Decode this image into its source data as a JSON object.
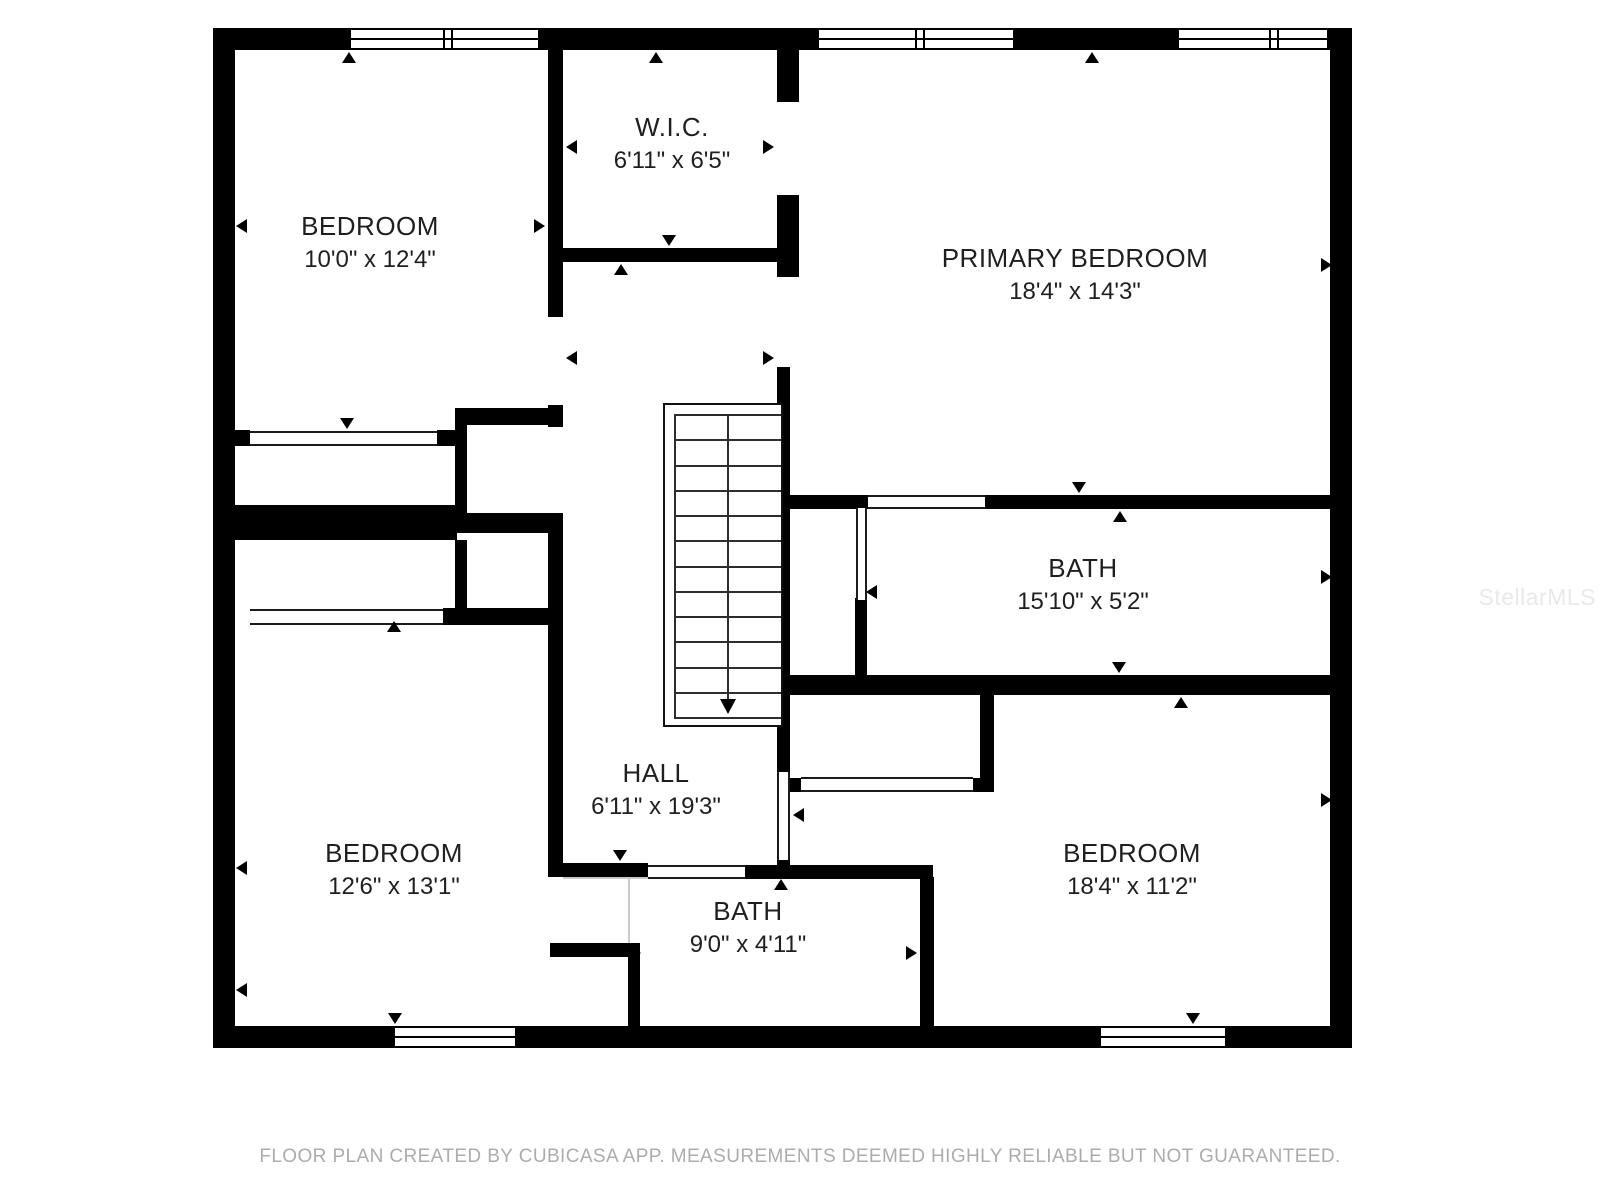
{
  "floorplan": {
    "background_color": "#ffffff",
    "wall_color": "#000000",
    "label_color": "#1f1f1f",
    "rooms": [
      {
        "name": "BEDROOM",
        "dims": "10'0\" x 12'4\"",
        "cx": 370,
        "cy": 243
      },
      {
        "name": "W.I.C.",
        "dims": "6'11\" x 6'5\"",
        "cx": 672,
        "cy": 144
      },
      {
        "name": "PRIMARY BEDROOM",
        "dims": "18'4\" x 14'3\"",
        "cx": 1075,
        "cy": 275
      },
      {
        "name": "BATH",
        "dims": "15'10\" x 5'2\"",
        "cx": 1083,
        "cy": 585
      },
      {
        "name": "HALL",
        "dims": "6'11\" x 19'3\"",
        "cx": 656,
        "cy": 790
      },
      {
        "name": "BEDROOM",
        "dims": "12'6\" x 13'1\"",
        "cx": 394,
        "cy": 870
      },
      {
        "name": "BATH",
        "dims": "9'0\" x 4'11\"",
        "cx": 748,
        "cy": 928
      },
      {
        "name": "BEDROOM",
        "dims": "18'4\" x 11'2\"",
        "cx": 1132,
        "cy": 870
      }
    ],
    "walls": [
      [
        213,
        28,
        22,
        1020
      ],
      [
        1330,
        28,
        22,
        1020
      ],
      [
        213,
        28,
        133,
        22
      ],
      [
        543,
        28,
        271,
        22
      ],
      [
        1018,
        28,
        156,
        22
      ],
      [
        213,
        1026,
        177,
        22
      ],
      [
        520,
        1026,
        576,
        22
      ],
      [
        1230,
        1026,
        122,
        22
      ],
      [
        548,
        50,
        15,
        267
      ],
      [
        777,
        50,
        22,
        52
      ],
      [
        777,
        195,
        22,
        82
      ],
      [
        562,
        248,
        237,
        14
      ],
      [
        777,
        367,
        13,
        405
      ],
      [
        213,
        505,
        244,
        35
      ],
      [
        455,
        408,
        12,
        120
      ],
      [
        455,
        408,
        105,
        17
      ],
      [
        548,
        405,
        15,
        22
      ],
      [
        548,
        513,
        15,
        112
      ],
      [
        455,
        513,
        105,
        20
      ],
      [
        455,
        540,
        12,
        85
      ],
      [
        443,
        608,
        120,
        17
      ],
      [
        235,
        430,
        15,
        16
      ],
      [
        437,
        430,
        20,
        16
      ],
      [
        548,
        625,
        15,
        252
      ],
      [
        548,
        863,
        100,
        14
      ],
      [
        550,
        943,
        90,
        14
      ],
      [
        628,
        943,
        12,
        83
      ],
      [
        745,
        865,
        188,
        14
      ],
      [
        920,
        877,
        14,
        149
      ],
      [
        788,
        495,
        80,
        14
      ],
      [
        985,
        495,
        367,
        14
      ],
      [
        855,
        598,
        12,
        77
      ],
      [
        788,
        675,
        564,
        20
      ],
      [
        980,
        690,
        14,
        100
      ],
      [
        790,
        778,
        12,
        14
      ],
      [
        973,
        778,
        21,
        14
      ],
      [
        777,
        858,
        13,
        10
      ]
    ],
    "windows": [
      {
        "x": 346,
        "y": 28,
        "w": 197,
        "h": 22,
        "m": [
          92,
          100
        ]
      },
      {
        "x": 814,
        "y": 28,
        "w": 204,
        "h": 22,
        "m": [
          96,
          104
        ]
      },
      {
        "x": 1174,
        "y": 28,
        "w": 158,
        "h": 22,
        "m": [
          90,
          98
        ]
      },
      {
        "x": 390,
        "y": 1026,
        "w": 130,
        "h": 22,
        "m": []
      },
      {
        "x": 1096,
        "y": 1026,
        "w": 134,
        "h": 22,
        "m": []
      }
    ],
    "openings": [
      {
        "x": 250,
        "y": 431,
        "w": 187,
        "h": 15,
        "o": "h"
      },
      {
        "x": 250,
        "y": 609,
        "w": 193,
        "h": 16,
        "o": "h"
      },
      {
        "x": 648,
        "y": 865,
        "w": 97,
        "h": 14,
        "o": "h"
      },
      {
        "x": 801,
        "y": 777,
        "w": 172,
        "h": 15,
        "o": "h"
      },
      {
        "x": 868,
        "y": 495,
        "w": 117,
        "h": 14,
        "o": "h"
      },
      {
        "x": 777,
        "y": 772,
        "w": 13,
        "h": 88,
        "o": "v"
      },
      {
        "x": 856,
        "y": 508,
        "w": 11,
        "h": 92,
        "o": "v"
      }
    ],
    "boundary_lines": [
      [
        563,
        877,
        85,
        2
      ],
      [
        628,
        877,
        2,
        66
      ]
    ],
    "markers": [
      {
        "x": 349,
        "y": 52,
        "dir": "up"
      },
      {
        "x": 656,
        "y": 52,
        "dir": "up"
      },
      {
        "x": 1092,
        "y": 52,
        "dir": "up"
      },
      {
        "x": 236,
        "y": 226,
        "dir": "left"
      },
      {
        "x": 236,
        "y": 868,
        "dir": "left"
      },
      {
        "x": 236,
        "y": 990,
        "dir": "left"
      },
      {
        "x": 545,
        "y": 226,
        "dir": "right"
      },
      {
        "x": 566,
        "y": 147,
        "dir": "left"
      },
      {
        "x": 774,
        "y": 147,
        "dir": "right"
      },
      {
        "x": 669,
        "y": 246,
        "dir": "down"
      },
      {
        "x": 621,
        "y": 264,
        "dir": "up"
      },
      {
        "x": 566,
        "y": 358,
        "dir": "left"
      },
      {
        "x": 774,
        "y": 358,
        "dir": "right"
      },
      {
        "x": 1079,
        "y": 493,
        "dir": "down"
      },
      {
        "x": 1120,
        "y": 511,
        "dir": "up"
      },
      {
        "x": 1332,
        "y": 265,
        "dir": "right"
      },
      {
        "x": 1332,
        "y": 577,
        "dir": "right"
      },
      {
        "x": 1332,
        "y": 800,
        "dir": "right"
      },
      {
        "x": 866,
        "y": 592,
        "dir": "left"
      },
      {
        "x": 1119,
        "y": 673,
        "dir": "down"
      },
      {
        "x": 1181,
        "y": 697,
        "dir": "up"
      },
      {
        "x": 620,
        "y": 861,
        "dir": "down"
      },
      {
        "x": 781,
        "y": 879,
        "dir": "up"
      },
      {
        "x": 641,
        "y": 953,
        "dir": "right"
      },
      {
        "x": 640,
        "y": 990,
        "dir": "right"
      },
      {
        "x": 917,
        "y": 953,
        "dir": "right"
      },
      {
        "x": 793,
        "y": 815,
        "dir": "left"
      },
      {
        "x": 395,
        "y": 1024,
        "dir": "down"
      },
      {
        "x": 1193,
        "y": 1024,
        "dir": "down"
      },
      {
        "x": 347,
        "y": 429,
        "dir": "down"
      },
      {
        "x": 394,
        "y": 621,
        "dir": "up"
      }
    ],
    "stairs": {
      "x": 663,
      "y": 403,
      "w": 120,
      "h": 324,
      "treads": 12,
      "divider_x": 62,
      "inset": 9
    }
  },
  "footer": {
    "text": "FLOOR PLAN CREATED BY CUBICASA APP. MEASUREMENTS DEEMED HIGHLY RELIABLE BUT NOT GUARANTEED."
  },
  "watermark": {
    "text": "StellarMLS"
  }
}
